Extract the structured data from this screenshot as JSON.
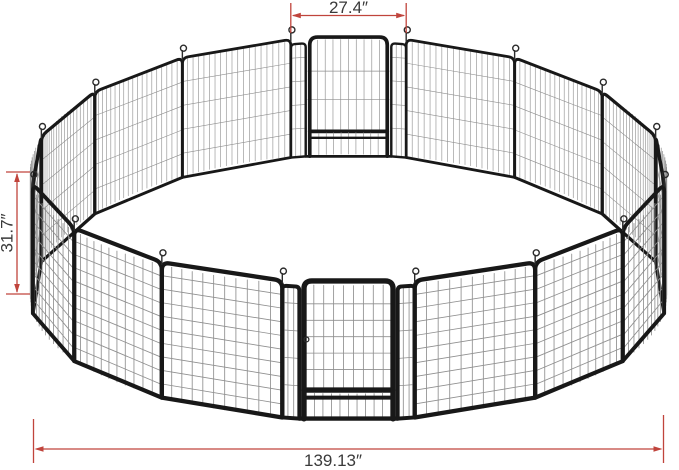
{
  "figure": {
    "subject": "16-panel metal pet playpen arranged in a circle with two walk-through door panels",
    "panel_count": 16,
    "door_panel_count": 2,
    "annotations": {
      "panel_width_label": "27.4″",
      "panel_height_label": "31.7″",
      "overall_width_label": "139.13″"
    },
    "colors": {
      "background": "#ffffff",
      "frame": "#181818",
      "mesh": "#8f8f8f",
      "hook": "#2b2b2b",
      "dimension_line": "#c0443c",
      "dimension_text": "#3a3a3a"
    }
  }
}
